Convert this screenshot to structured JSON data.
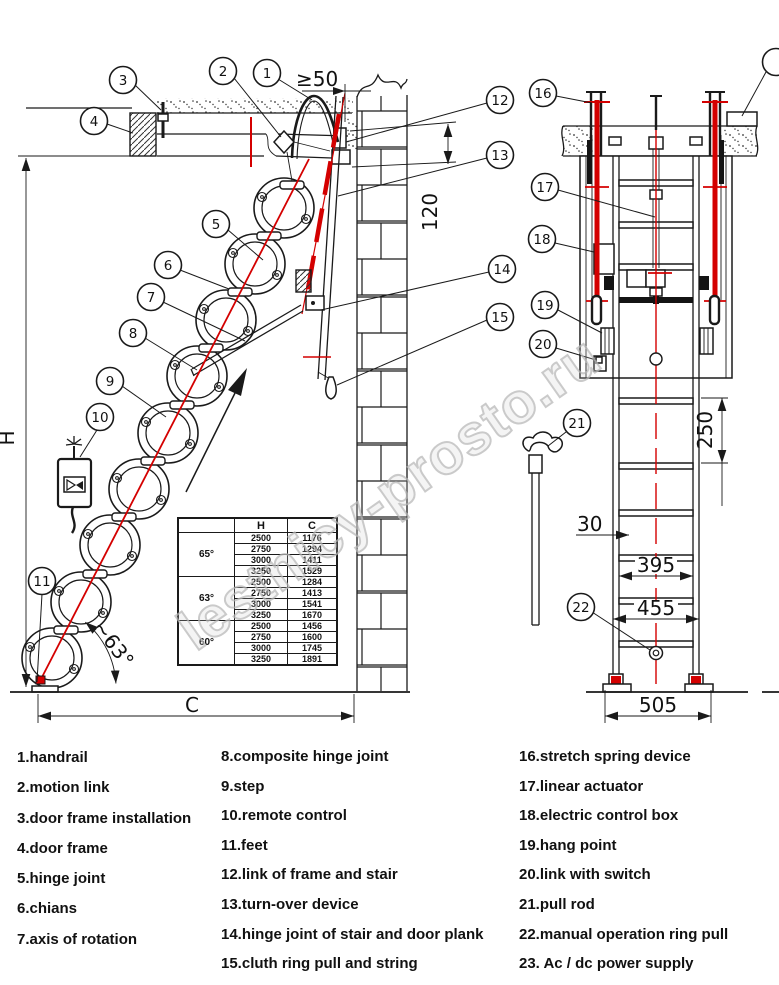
{
  "watermark": "lestnicy-prosto.ru",
  "balloons": {
    "b1": "1",
    "b2": "2",
    "b3": "3",
    "b4": "4",
    "b5": "5",
    "b6": "6",
    "b7": "7",
    "b8": "8",
    "b9": "9",
    "b10": "10",
    "b11": "11",
    "b12": "12",
    "b13": "13",
    "b14": "14",
    "b15": "15",
    "b16": "16",
    "b17": "17",
    "b18": "18",
    "b19": "19",
    "b20": "20",
    "b21": "21",
    "b22": "22"
  },
  "dims": {
    "side": {
      "gap": "≥50",
      "depth": "120",
      "height": "H",
      "width": "C",
      "angle": "~63°"
    },
    "front": {
      "rung": "250",
      "step": "30",
      "inner": "395",
      "outer": "455",
      "base": "505"
    }
  },
  "table": {
    "headers": {
      "angle": "",
      "h": "H",
      "c": "C"
    },
    "groups": [
      {
        "angle": "65°",
        "rows": [
          [
            "2500",
            "1176"
          ],
          [
            "2750",
            "1294"
          ],
          [
            "3000",
            "1411"
          ],
          [
            "3250",
            "1529"
          ]
        ]
      },
      {
        "angle": "63°",
        "rows": [
          [
            "2500",
            "1284"
          ],
          [
            "2750",
            "1413"
          ],
          [
            "3000",
            "1541"
          ],
          [
            "3250",
            "1670"
          ]
        ]
      },
      {
        "angle": "60°",
        "rows": [
          [
            "2500",
            "1456"
          ],
          [
            "2750",
            "1600"
          ],
          [
            "3000",
            "1745"
          ],
          [
            "3250",
            "1891"
          ]
        ]
      }
    ]
  },
  "legend": {
    "col1": [
      "1.handrail",
      "2.motion link",
      "3.door frame installation",
      "4.door frame",
      "5.hinge joint",
      "6.chians",
      "7.axis of rotation"
    ],
    "col2": [
      "8.composite hinge joint",
      "9.step",
      "10.remote control",
      "11.feet",
      "12.link of frame and stair",
      "13.turn-over device",
      "14.hinge joint of stair and door plank",
      "15.cluth ring pull and string"
    ],
    "col3": [
      "16.stretch spring device",
      "17.linear actuator",
      "18.electric control box",
      "19.hang point",
      "20.link with switch",
      "21.pull rod",
      "22.manual operation ring pull",
      "23. Ac / dc power supply"
    ]
  }
}
